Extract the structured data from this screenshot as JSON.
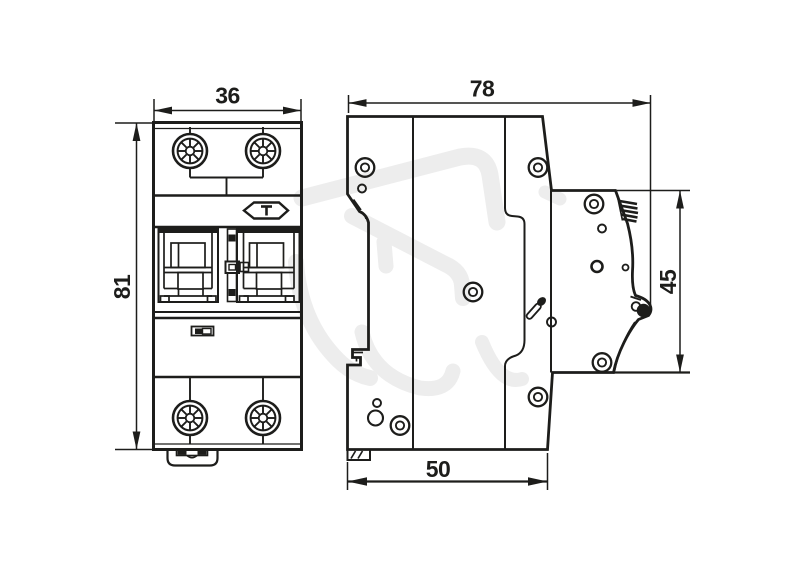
{
  "drawing": {
    "description": "Dimensional technical drawing of a 2-pole DIN-rail circuit breaker, front view and side view",
    "unit_labels": {
      "front_width": "36",
      "front_height": "81",
      "side_depth": "78",
      "din_recess_height": "45",
      "base_depth": "50"
    }
  },
  "colors": {
    "line": "#1d1d1b",
    "watermark": "#ededed",
    "background": "#ffffff"
  }
}
